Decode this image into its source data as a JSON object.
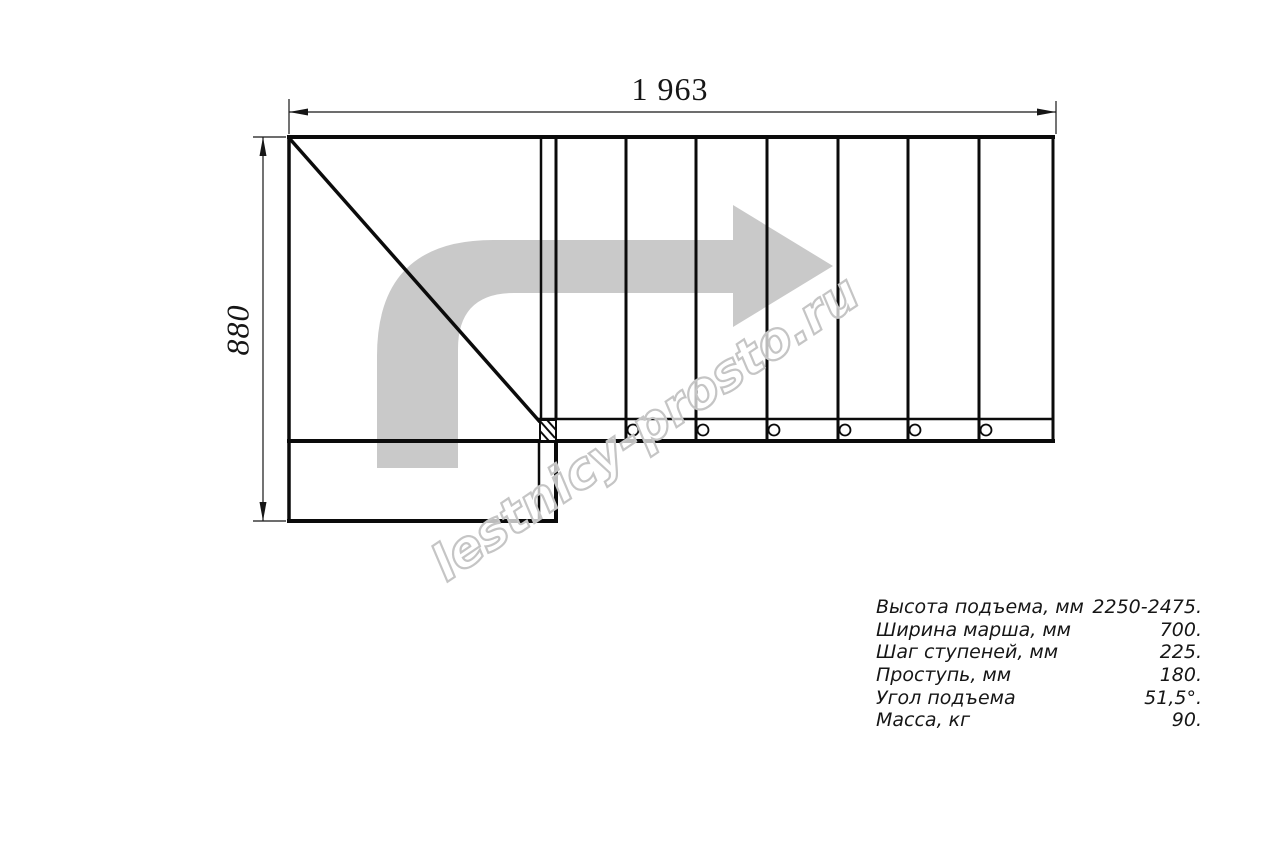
{
  "drawing": {
    "top_dimension": "1 963",
    "left_dimension": "880"
  },
  "watermark": {
    "text": "lestnicy-prosto.ru"
  },
  "specs": {
    "rows": [
      {
        "label": "Высота подъема, мм",
        "value": "2250-2475."
      },
      {
        "label": "Ширина марша, мм",
        "value": "700."
      },
      {
        "label": "Шаг ступеней, мм",
        "value": "225."
      },
      {
        "label": "Проступь, мм",
        "value": "180."
      },
      {
        "label": "Угол подъема",
        "value": "51,5°."
      },
      {
        "label": "Масса, кг",
        "value": "90."
      }
    ]
  },
  "colors": {
    "line": "#0b0b0b",
    "arrow": "#c9c9c9",
    "watermark_outline": "#c5c5c5",
    "text": "#161616"
  }
}
